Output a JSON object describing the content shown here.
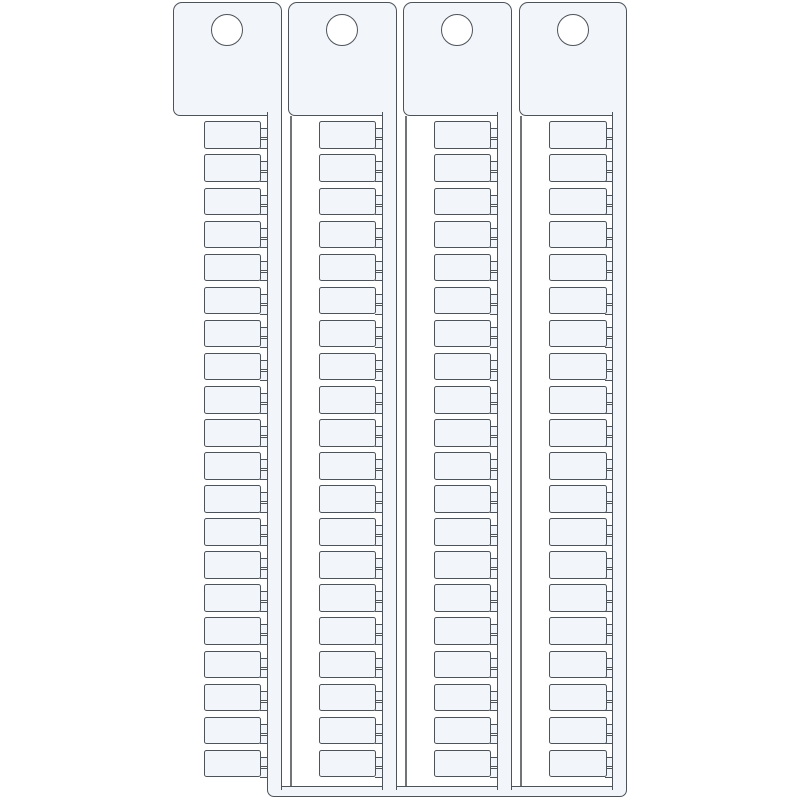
{
  "scene": {
    "name": "terminal-block-tag-strips",
    "strip_count": 4,
    "tags_per_strip": 20,
    "nubs_per_tag": 2,
    "holes_per_strip": 1,
    "colors": {
      "background": "#ffffff",
      "strip_fill": "#f2f5f9",
      "outline": "#4d535a",
      "hole_fill": "#ffffff",
      "thin_rail": "#70757a"
    }
  }
}
